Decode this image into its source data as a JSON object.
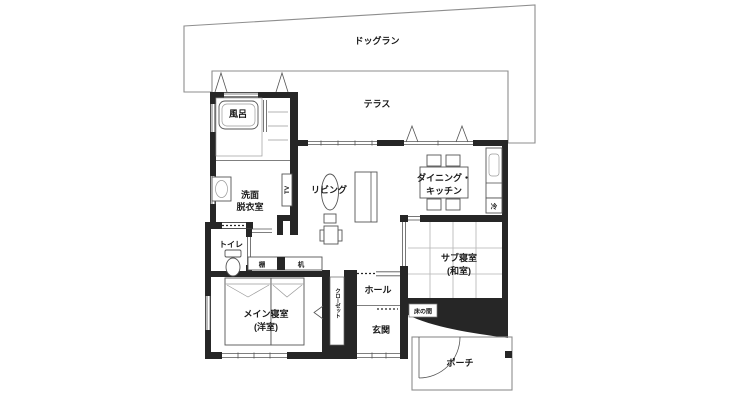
{
  "plan": {
    "outdoor": {
      "dog_run": "ドッグラン",
      "terrace": "テラス",
      "porch": "ポーチ"
    },
    "rooms": {
      "bath": "風呂",
      "washroom": [
        "洗面",
        "脱衣室"
      ],
      "toilet": "トイレ",
      "living": "リビング",
      "dining_kitchen": [
        "ダイニング・",
        "キッチン"
      ],
      "sub_bedroom": [
        "サブ寝室",
        "(和室)"
      ],
      "main_bedroom": [
        "メイン寝室",
        "(洋室)"
      ],
      "hall": "ホール",
      "entrance": "玄関"
    },
    "fixtures": {
      "tv": "TV",
      "fridge": "冷",
      "shelf": "棚",
      "desk": "机",
      "closet": "クローゼット",
      "tokonoma": "床の間"
    },
    "colors": {
      "wall": "#262626",
      "thin_line": "#555555",
      "outline": "#8e8e8e",
      "text": "#1a1a1a",
      "tatami": "#b3b3b3"
    }
  }
}
